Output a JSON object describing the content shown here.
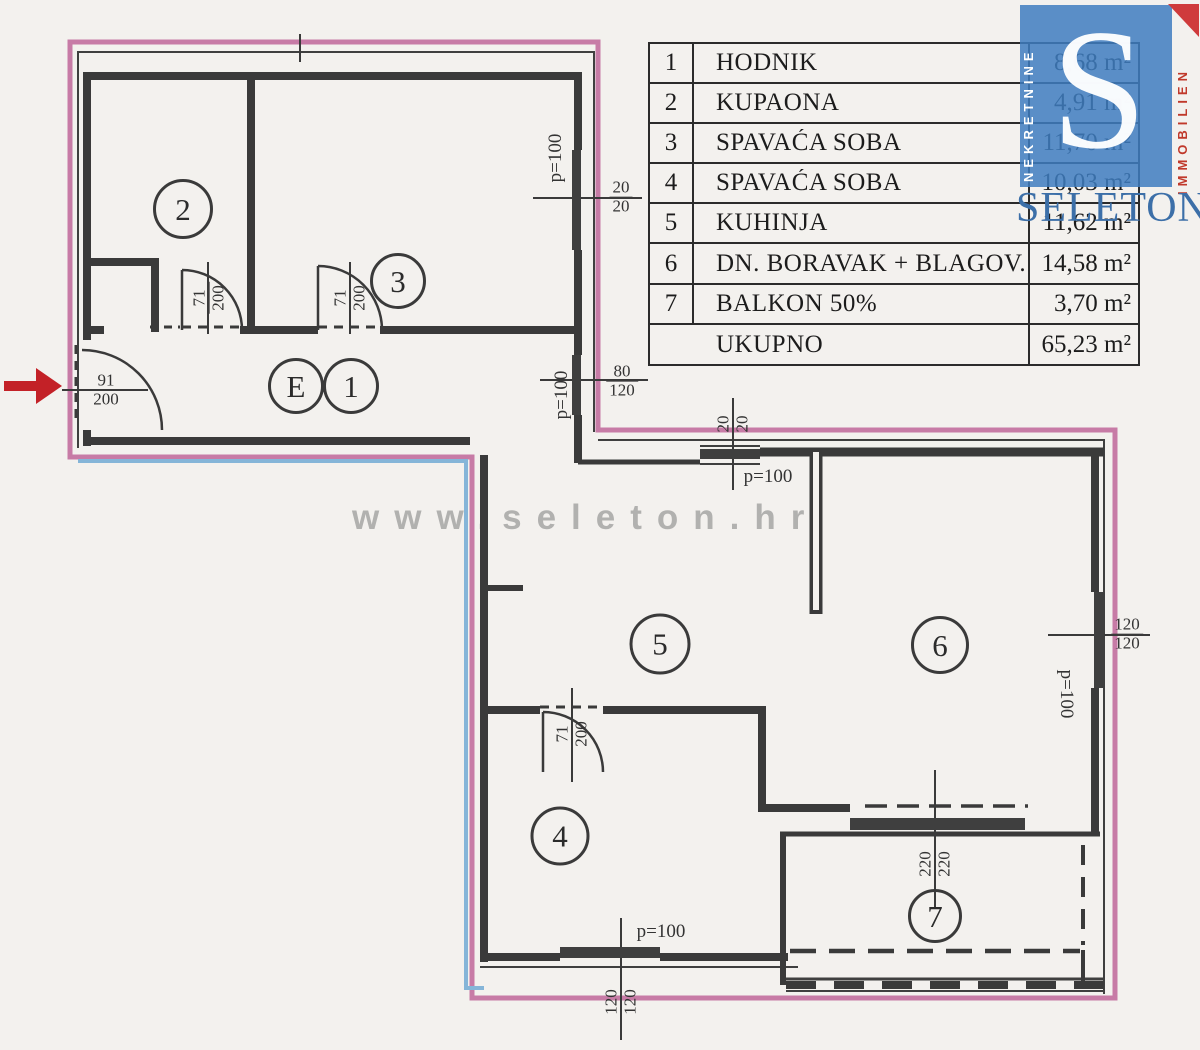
{
  "colors": {
    "boundary_pink": "#c77ba6",
    "boundary_blue": "#85b5d8",
    "wall_dark": "#3a3a3a",
    "arrow_red": "#c32127",
    "logo_blue": "#3e7cbf",
    "logo_red": "#c0392b",
    "brand_blue": "#3c6fa8",
    "watermark_gray": "#8a8a8a"
  },
  "watermark": {
    "text": "www.seleton.hr"
  },
  "legend": {
    "rows": [
      {
        "num": "1",
        "name": "HODNIK",
        "area": "8,68 m²"
      },
      {
        "num": "2",
        "name": "KUPAONA",
        "area": "4,91 m²"
      },
      {
        "num": "3",
        "name": "SPAVAĆA SOBA",
        "area": "11,70 m²"
      },
      {
        "num": "4",
        "name": "SPAVAĆA SOBA",
        "area": "10,03 m²"
      },
      {
        "num": "5",
        "name": "KUHINJA",
        "area": "11,62 m²"
      },
      {
        "num": "6",
        "name": "DN. BORAVAK + BLAGOV.",
        "area": "14,58 m²"
      },
      {
        "num": "7",
        "name": "BALKON 50%",
        "area": "3,70 m²"
      },
      {
        "num": "",
        "name": "UKUPNO",
        "area": "65,23 m²"
      }
    ]
  },
  "plan": {
    "circles": [
      {
        "label": "2"
      },
      {
        "label": "3"
      },
      {
        "label": "E"
      },
      {
        "label": "1"
      },
      {
        "label": "5"
      },
      {
        "label": "6"
      },
      {
        "label": "4"
      },
      {
        "label": "7"
      }
    ],
    "fracs": [
      {
        "top": "91",
        "bottom": "200"
      },
      {
        "top": "71",
        "bottom": "200"
      },
      {
        "top": "71",
        "bottom": "200"
      },
      {
        "top": "20",
        "bottom": "20"
      },
      {
        "top": "80",
        "bottom": "120"
      },
      {
        "top": "20",
        "bottom": "20"
      },
      {
        "top": "71",
        "bottom": "200"
      },
      {
        "top": "220",
        "bottom": "220"
      },
      {
        "top": "120",
        "bottom": "120"
      },
      {
        "top": "120",
        "bottom": "120"
      }
    ],
    "plabels": [
      "p=100",
      "p=100",
      "p=100",
      "p=100",
      "p=100"
    ]
  },
  "logo": {
    "letter": "S",
    "left_vertical": "NEKRETNINE",
    "right_vertical": "IMMOBILIEN",
    "brand": "SELETON"
  }
}
